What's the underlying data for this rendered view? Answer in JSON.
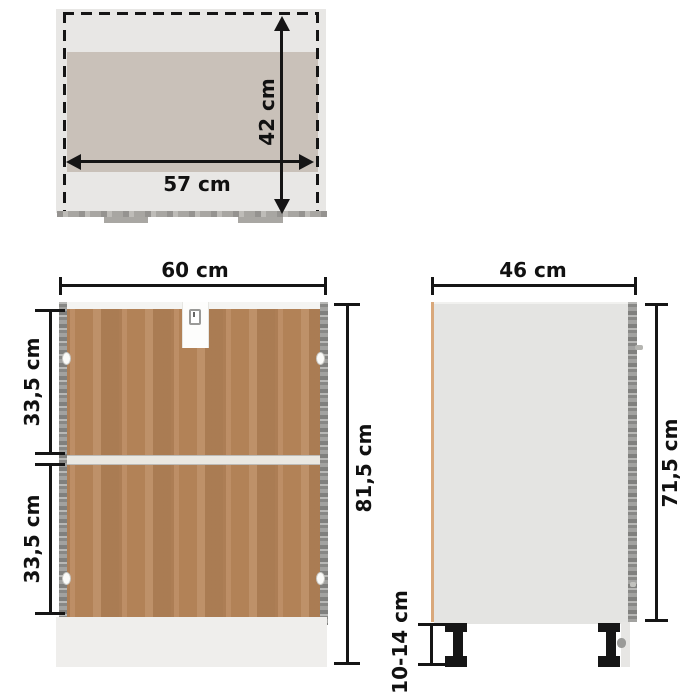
{
  "image_type": "furniture-dimension-diagram",
  "views": {
    "top": {
      "title": "top-interior-view",
      "width_label": "57 cm",
      "depth_label": "42 cm"
    },
    "front": {
      "title": "rear-view",
      "width_label": "60 cm",
      "upper_section_label": "33,5 cm",
      "lower_section_label": "33,5 cm",
      "total_height_label": "81,5 cm"
    },
    "side": {
      "title": "side-view",
      "depth_label": "46 cm",
      "body_height_label": "71,5 cm",
      "legs_height_label": "10-14 cm"
    }
  },
  "colors": {
    "background": "#ffffff",
    "dimension_lines": "#151515",
    "label_text": "#111111",
    "top_view_outer_gray": "#e8e7e5",
    "top_view_inner_tan": "#c9c1b9",
    "back_panel_brown": "#b8865a",
    "side_panel_concrete_gray": "#9c9c9a",
    "side_view_body_gray": "#e4e4e2",
    "front_edge_tan": "#d9a87b",
    "plinth_light_gray": "#efeeec",
    "legs_black": "#161616"
  }
}
